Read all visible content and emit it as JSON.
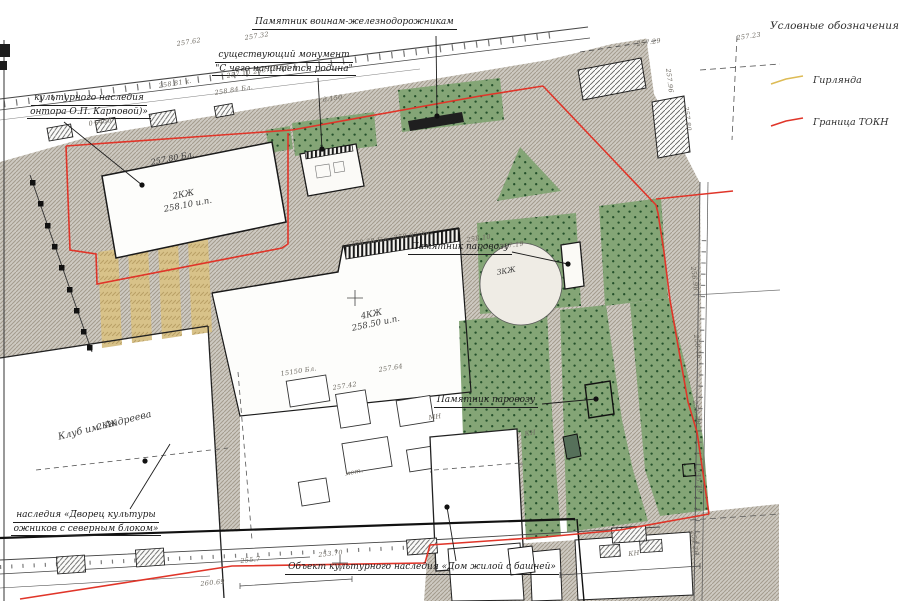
{
  "legend": {
    "title": "Условные обозначения",
    "items": [
      {
        "id": "garland",
        "label": "Гирлянда",
        "color": "#ddbb55"
      },
      {
        "id": "tokn-boundary",
        "label": "Граница ТОКН",
        "color": "#e03529"
      }
    ]
  },
  "colors": {
    "boundary_red": "#e03529",
    "garland_yellow": "#d8c289",
    "lawn_green": "#84a576",
    "pavement_gray": "#cecac2"
  },
  "callouts": [
    {
      "id": "monument-railwaymen",
      "lines": [
        "Памятник воинам-железнодорожникам"
      ],
      "x": 252,
      "y": 16,
      "w": 190
    },
    {
      "id": "existing-monument",
      "lines": [
        "существующий монумент",
        "\"С чего начинается родина\""
      ],
      "x": 192,
      "y": 49,
      "w": 184
    },
    {
      "id": "heritage-karpova",
      "lines": [
        "культурного наследия",
        "онтора О.П. Карповой)»"
      ],
      "x": -14,
      "y": 92,
      "w": 206
    },
    {
      "id": "locomotive-monument-1",
      "lines": [
        "Памятник паровозу"
      ],
      "x": 404,
      "y": 241,
      "w": 112
    },
    {
      "id": "locomotive-monument-2",
      "lines": [
        "Памятник паровозу"
      ],
      "x": 428,
      "y": 394,
      "w": 116
    },
    {
      "id": "heritage-palace",
      "lines": [
        "наследия «Дворец культуры",
        "ожников с северным блоком»"
      ],
      "x": -12,
      "y": 509,
      "w": 196
    },
    {
      "id": "heritage-house-tower",
      "lines": [
        "Объект культурного наследия «Дом жилой с башней»"
      ],
      "x": 280,
      "y": 561,
      "w": 284
    }
  ],
  "leaders": [
    {
      "x1": 436,
      "y1": 36,
      "x2": 437,
      "y2": 116,
      "dot": true
    },
    {
      "x1": 318,
      "y1": 78,
      "x2": 322,
      "y2": 149,
      "dot": true
    },
    {
      "x1": 64,
      "y1": 122,
      "x2": 142,
      "y2": 185,
      "dot": true
    },
    {
      "x1": 512,
      "y1": 252,
      "x2": 568,
      "y2": 264,
      "dot": true
    },
    {
      "x1": 542,
      "y1": 404,
      "x2": 596,
      "y2": 399,
      "dot": true
    },
    {
      "x1": 130,
      "y1": 509,
      "x2": 170,
      "y2": 444,
      "dot": false
    },
    {
      "x1": 456,
      "y1": 561,
      "x2": 447,
      "y2": 507,
      "dot": true
    },
    {
      "x1": 145,
      "y1": 461,
      "x2": 145,
      "y2": 461,
      "dot": true
    }
  ],
  "building_labels": [
    {
      "text": "257.80 Бл.",
      "x": 150,
      "y": 158,
      "rot": -11,
      "size": 8
    },
    {
      "text": "2КЖ",
      "x": 172,
      "y": 192,
      "rot": -11,
      "size": 8.5
    },
    {
      "text": "258.10 и.п.",
      "x": 163,
      "y": 205,
      "rot": -11,
      "size": 8.5
    },
    {
      "text": "4КЖ",
      "x": 360,
      "y": 312,
      "rot": -12,
      "size": 8.5
    },
    {
      "text": "258.50 и.п.",
      "x": 351,
      "y": 324,
      "rot": -12,
      "size": 8.5
    },
    {
      "text": "2КЖ",
      "x": 96,
      "y": 423,
      "rot": -14,
      "size": 8
    },
    {
      "text": "Клуб им. Андреева",
      "x": 57,
      "y": 432,
      "rot": -14,
      "size": 9.5
    },
    {
      "text": "3КЖ",
      "x": 496,
      "y": 268,
      "rot": -10,
      "size": 7.5
    }
  ],
  "survey_marks": [
    {
      "text": "257.62",
      "x": 176,
      "y": 40,
      "rot": -9
    },
    {
      "text": "257.32",
      "x": 244,
      "y": 34,
      "rot": -9
    },
    {
      "text": "258.84 Бл.",
      "x": 214,
      "y": 89,
      "rot": -9
    },
    {
      "text": "257.10  253.79 Бл.",
      "x": 226,
      "y": 72,
      "rot": -9
    },
    {
      "text": "258.81 к.",
      "x": 158,
      "y": 82,
      "rot": -9
    },
    {
      "text": "0+450",
      "x": 88,
      "y": 120,
      "rot": -10
    },
    {
      "text": "д.150",
      "x": 322,
      "y": 96,
      "rot": -9
    },
    {
      "text": "257.29",
      "x": 636,
      "y": 40,
      "rot": -8
    },
    {
      "text": "257.23",
      "x": 736,
      "y": 34,
      "rot": -8
    },
    {
      "text": "257.96",
      "x": 672,
      "y": 68,
      "rot": 83
    },
    {
      "text": "257.80",
      "x": 690,
      "y": 106,
      "rot": 83
    },
    {
      "text": "256.98",
      "x": 697,
      "y": 266,
      "rot": 83
    },
    {
      "text": "258.46",
      "x": 700,
      "y": 334,
      "rot": 83
    },
    {
      "text": "256.38",
      "x": 699,
      "y": 400,
      "rot": 83
    },
    {
      "text": "255.79",
      "x": 701,
      "y": 468,
      "rot": 83
    },
    {
      "text": "254.26",
      "x": 697,
      "y": 530,
      "rot": 83
    },
    {
      "text": "15150 Бл.",
      "x": 280,
      "y": 370,
      "rot": -9
    },
    {
      "text": "257.42",
      "x": 332,
      "y": 384,
      "rot": -9
    },
    {
      "text": "257.64",
      "x": 378,
      "y": 366,
      "rot": -9
    },
    {
      "text": "мет.",
      "x": 344,
      "y": 470,
      "rot": -12
    },
    {
      "text": "МН",
      "x": 428,
      "y": 414,
      "rot": -9
    },
    {
      "text": "КН",
      "x": 524,
      "y": 430,
      "rot": -9
    },
    {
      "text": "255.7",
      "x": 240,
      "y": 557,
      "rot": -6
    },
    {
      "text": "253.70",
      "x": 318,
      "y": 551,
      "rot": -6
    },
    {
      "text": "260.69",
      "x": 200,
      "y": 580,
      "rot": -6
    },
    {
      "text": "КН",
      "x": 628,
      "y": 550,
      "rot": -6
    },
    {
      "text": "258.38 Бл., 258.92 Ан.",
      "x": 350,
      "y": 240,
      "rot": -8
    },
    {
      "text": "258.10",
      "x": 466,
      "y": 236,
      "rot": -8
    },
    {
      "text": "257.19",
      "x": 499,
      "y": 243,
      "rot": -8
    }
  ]
}
